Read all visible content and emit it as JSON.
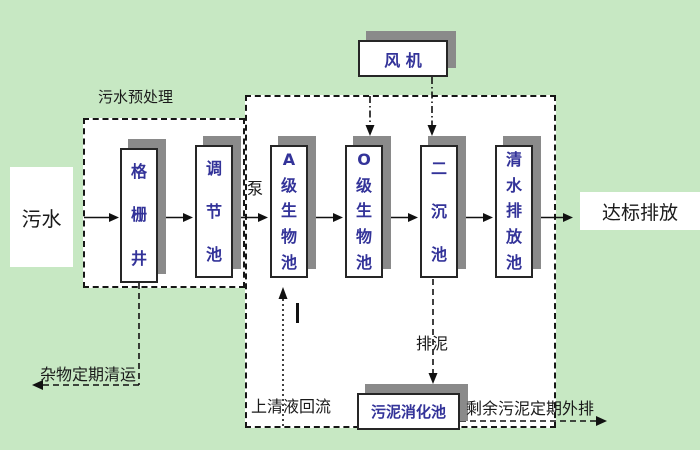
{
  "colors": {
    "background": "#c7e8c3",
    "shadow": "#8a8a8a",
    "box_text": "#333399",
    "line": "#111111"
  },
  "boxes": {
    "influent": "污水",
    "grid_well": "格栅井",
    "regulating_tank": "调节池",
    "a_bio_tank": "A级生物池",
    "o_bio_tank": "O级生物池",
    "secondary_clarifier": "二沉池",
    "clear_water_tank": "清水排放池",
    "sludge_digestion_tank": "污泥消化池",
    "fan": "风 机",
    "discharge": "达标排放"
  },
  "labels": {
    "pretreatment_title": "污水预处理",
    "pump": "泵",
    "debris_removal": "杂物定期清运",
    "supernatant_return": "上清液回流",
    "sludge_discharge": "排泥",
    "excess_sludge": "剩余污泥定期外排"
  }
}
